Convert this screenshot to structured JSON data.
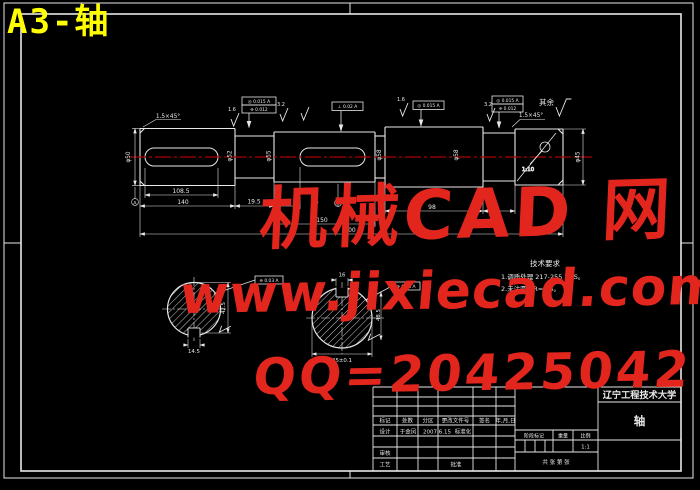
{
  "sheet": {
    "label": "A3-轴"
  },
  "watermark": {
    "brand": "机械CAD 网",
    "url": "www.jixiecad.com",
    "qq": "QQ=20425042",
    "color": "#e3261d"
  },
  "notes": {
    "title": "技术要求",
    "line1": "1.调质处理 217-255 HBS。",
    "line2": "2.未注圆角R=1.5。"
  },
  "finish": {
    "rest_label": "其余",
    "marks": [
      "1.6",
      "3.2",
      "1.6",
      "3.2"
    ]
  },
  "dims": {
    "chamfer_left": "1.5×45°",
    "chamfer_right": "1.5×45°",
    "key1_len": "108.5",
    "sec1_len": "140",
    "neck_len": "19.5",
    "key2_pos": "14",
    "mid_len": "150",
    "right_len": "98",
    "overall": "300",
    "dia1": "φ50",
    "dia2": "φ52",
    "dia3": "φ55",
    "dia4": "φ58",
    "dia5": "φ58",
    "dia6": "φ45",
    "taper": "1:10",
    "secA_width": "14.5",
    "secA_height": "42.5",
    "secB_key": "16",
    "secB_width": "45±0.1",
    "secB_height": "48.5",
    "datumA": "A",
    "datumB": "B",
    "fcf1a": "◎ 0.015 A",
    "fcf1b": "⌯ 0.012",
    "fcf2": "⊥ 0.02 A",
    "fcf3": "◎ 0.015 A",
    "fcf4a": "◎ 0.015 A",
    "fcf4b": "⌯ 0.012",
    "fcfA": "⌯ 0.03 A",
    "fcfB": "⌯ 0.03 A"
  },
  "title_block": {
    "university": "辽宁工程技术大学",
    "part_name": "轴",
    "scale_value": "1:1",
    "header": [
      "标记",
      "处数",
      "分区",
      "更改文件号",
      "签名",
      "年,月,日"
    ],
    "design": "设计",
    "designer": "于金凤",
    "date": "2007.6.15",
    "standard": "标准化",
    "check": "审核",
    "process": "工艺",
    "approve": "批准",
    "stage": "阶段标记",
    "weight": "重量",
    "scale": "比例",
    "sheet": "共 张 第 张"
  }
}
